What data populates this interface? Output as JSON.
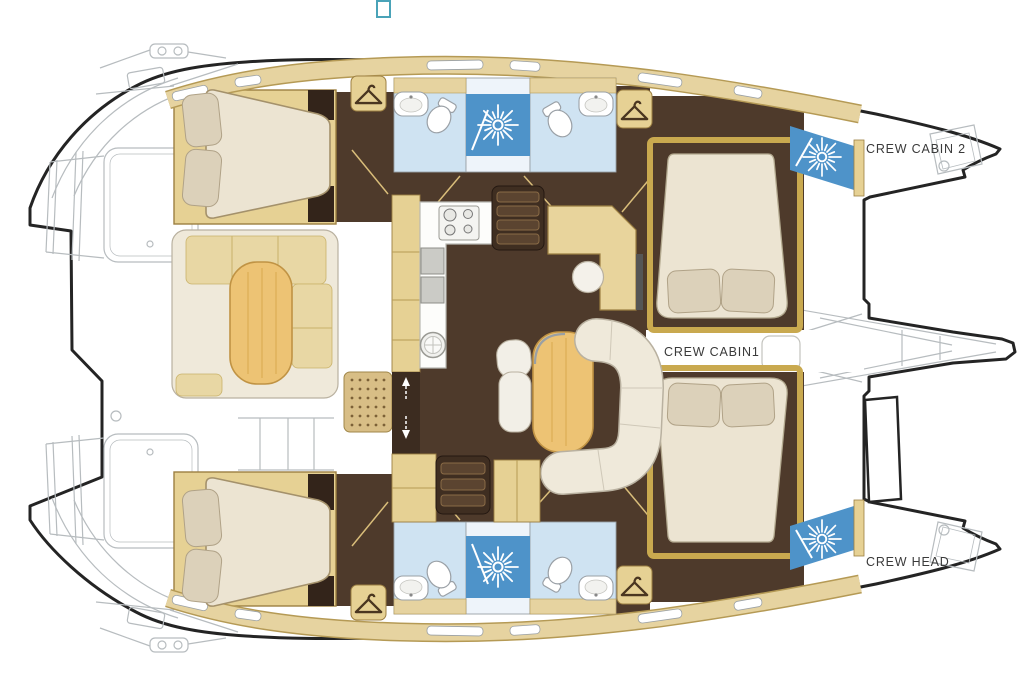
{
  "plan": {
    "labels": {
      "crew_cabin_2": "CREW CABIN 2",
      "crew_cabin_1": "CREW CABIN1",
      "crew_head": "CREW HEAD"
    },
    "colors": {
      "hull_outline": "#242424",
      "line_art_gray": "#b7bcbf",
      "wall_tan": "#e6d194",
      "wall_tan_border": "#9c7f42",
      "deck_band": "#e6d3a0",
      "deck_band_border": "#b59a55",
      "floor_dark_brown": "#4e3a2b",
      "wardrobe_dark": "#33241a",
      "mattress_cream": "#ece4d2",
      "pillow_beige": "#dcd1ba",
      "upholstery_cream": "#efe9da",
      "cushion_tan": "#e8d7a4",
      "table_wood": "#edc374",
      "bath_light_blue": "#cfe3f2",
      "shower_blue": "#4e93c9",
      "counter_white": "#fdfdfb",
      "mast_teal": "#4aa3b8",
      "label_text": "#3a3a3a"
    },
    "icons": [
      "mast-icon",
      "shower-spray-icon",
      "hanger-icon",
      "toilet-icon",
      "sink-icon",
      "stove-icon",
      "fridge-icon",
      "round-sink-icon",
      "stairs-icon",
      "companionway-arrows-icon",
      "deck-grate-icon"
    ]
  }
}
